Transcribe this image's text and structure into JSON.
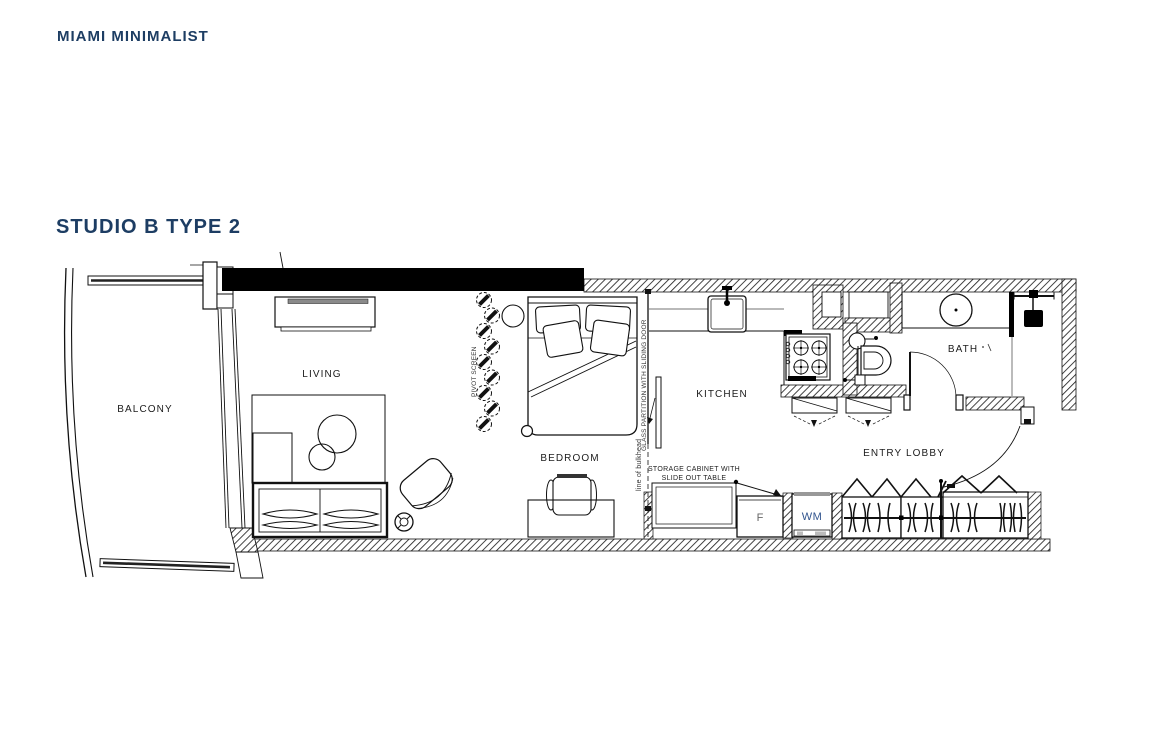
{
  "page": {
    "brand": "MIAMI MINIMALIST",
    "title": "STUDIO B TYPE 2"
  },
  "colors": {
    "navy": "#1d3d63",
    "wm_blue": "#31548e",
    "line": "#111111"
  },
  "plan": {
    "rooms": {
      "balcony": "BALCONY",
      "living": "LIVING",
      "bedroom": "BEDROOM",
      "kitchen": "KITCHEN",
      "bath": "BATH",
      "entry": "ENTRY LOBBY"
    },
    "annotations": {
      "pivot_screen": "PIVOT SCREEN",
      "glass_partition": "GLASS PARTITION WITH SLIDING DOOR",
      "bulkhead": "line of bulkhead",
      "storage_line1": "STORAGE CABINET WITH",
      "storage_line2": "SLIDE OUT TABLE",
      "fridge": "F",
      "washer": "WM"
    }
  }
}
